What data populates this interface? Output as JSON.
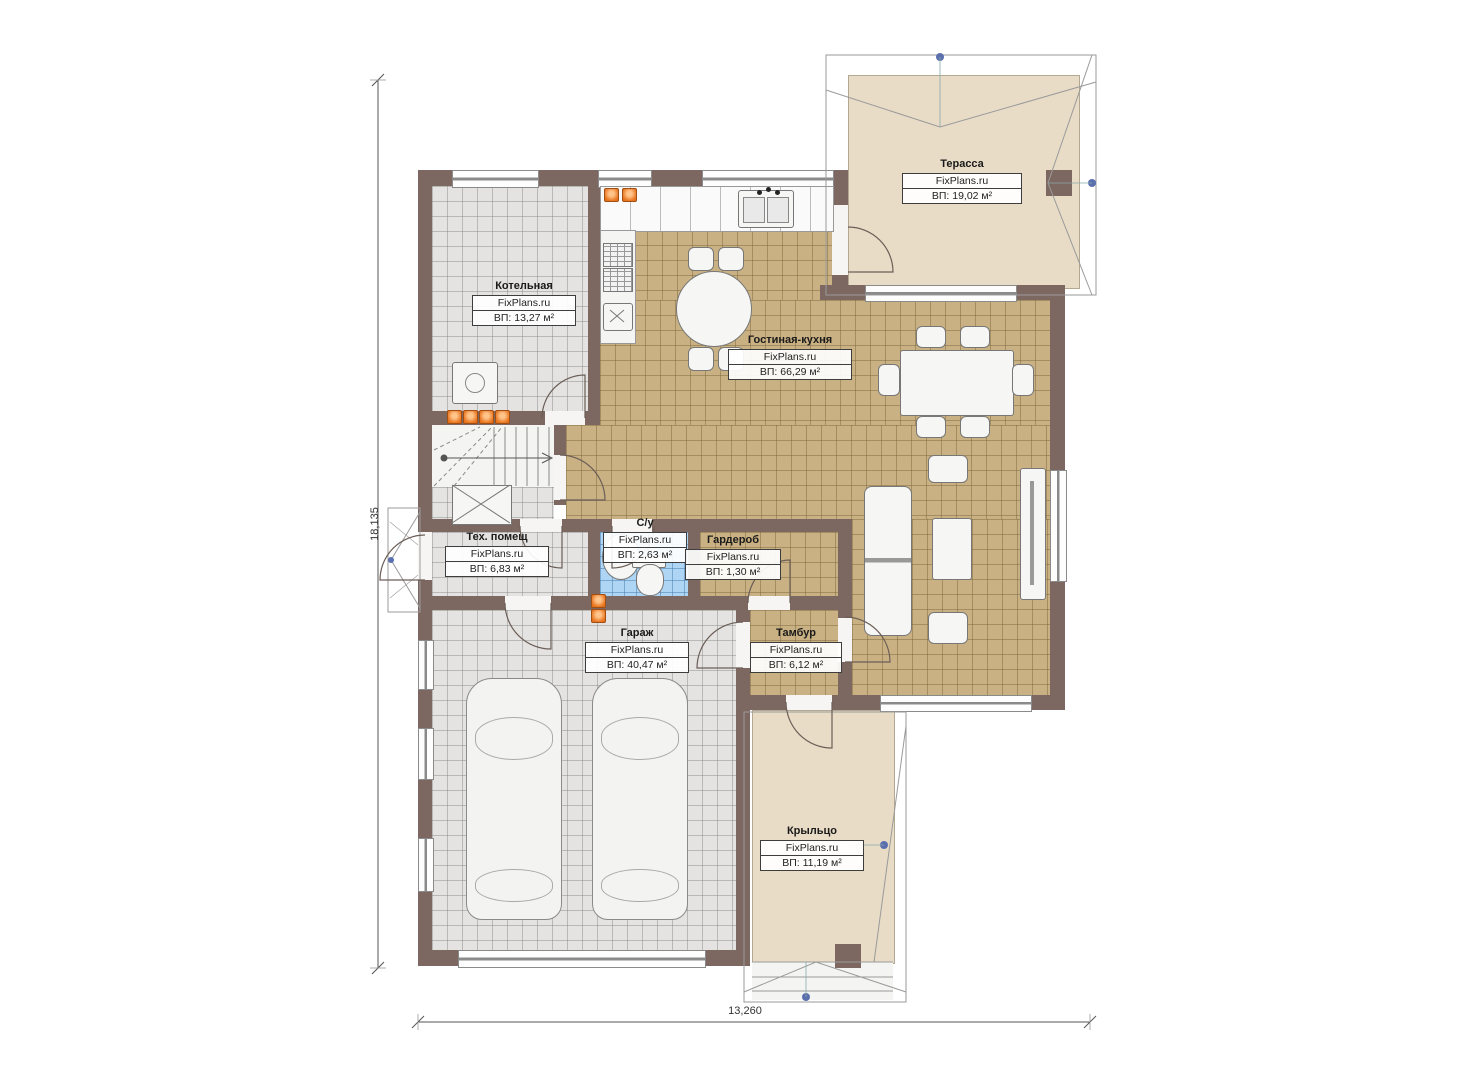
{
  "plan": {
    "rooms": [
      {
        "id": "terrace",
        "name": "Терасса",
        "brand": "FixPlans.ru",
        "area": "ВП: 19,02 м²"
      },
      {
        "id": "boiler",
        "name": "Котельная",
        "brand": "FixPlans.ru",
        "area": "ВП: 13,27 м²"
      },
      {
        "id": "living_kitchen",
        "name": "Гостиная-кухня",
        "brand": "FixPlans.ru",
        "area": "ВП: 66,29 м²"
      },
      {
        "id": "tech",
        "name": "Тех. помещ",
        "brand": "FixPlans.ru",
        "area": "ВП: 6,83 м²"
      },
      {
        "id": "bathroom",
        "name": "С/у",
        "brand": "FixPlans.ru",
        "area": "ВП: 2,63 м²"
      },
      {
        "id": "wardrobe",
        "name": "Гардероб",
        "brand": "FixPlans.ru",
        "area": "ВП: 1,30 м²"
      },
      {
        "id": "garage",
        "name": "Гараж",
        "brand": "FixPlans.ru",
        "area": "ВП: 40,47 м²"
      },
      {
        "id": "tambour",
        "name": "Тамбур",
        "brand": "FixPlans.ru",
        "area": "ВП: 6,12 м²"
      },
      {
        "id": "porch",
        "name": "Крыльцо",
        "brand": "FixPlans.ru",
        "area": "ВП: 11,19 м²"
      }
    ],
    "dimensions": {
      "left": "18,135",
      "bottom": "13,260"
    },
    "colors": {
      "wall": "#7d6861",
      "tile_living": "#c9b183",
      "tile_utility": "#e4e3e1",
      "tile_bath": "#aed6f4",
      "outdoor": "#e8dcc7",
      "radiator": "#e8731e",
      "marker": "#5b6fae"
    }
  }
}
